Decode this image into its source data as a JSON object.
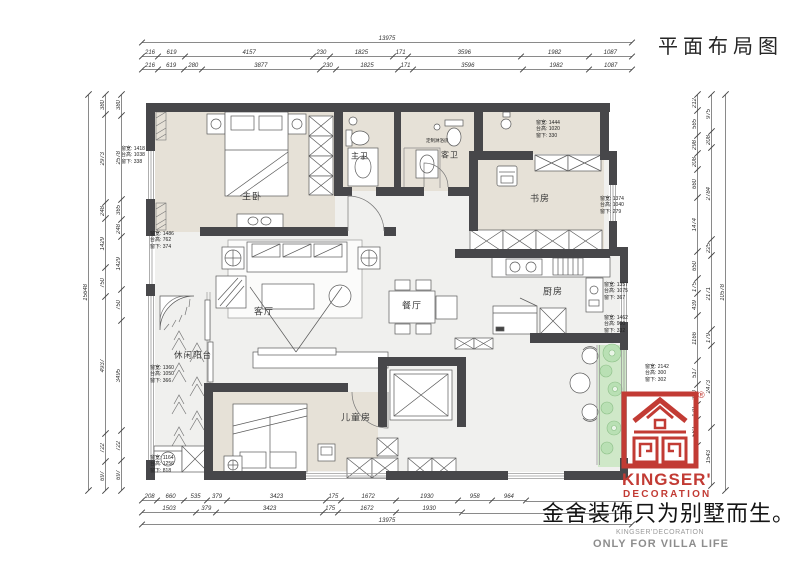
{
  "title": "平面布局图",
  "rooms": {
    "master": "主卧",
    "master_bath": "主卫",
    "guest_bath": "客卫",
    "study": "书房",
    "dining": "餐厅",
    "kitchen": "厨房",
    "living": "客厅",
    "leisure_balcony": "休闲阳台",
    "kids": "儿童房"
  },
  "shower_note": "定制淋浴房",
  "dims": {
    "top_overall": [
      "13975"
    ],
    "top_detail1": [
      "216",
      "619",
      "4157",
      "230",
      "1825",
      "171",
      "3596",
      "1982",
      "1087"
    ],
    "top_detail2": [
      "216",
      "619",
      "280",
      "3877",
      "230",
      "1825",
      "171",
      "3596",
      "1982",
      "1087"
    ],
    "bottom_detail1": [
      "208",
      "660",
      "535",
      "379",
      "3423",
      "175",
      "1672",
      "1930",
      "958",
      "964"
    ],
    "bottom_detail2": [
      "1503",
      "379",
      "3423",
      "175",
      "1672",
      "1930"
    ],
    "bottom_overall": [
      "13975"
    ],
    "left_overall": [
      "15648"
    ],
    "left_mid": [
      "380",
      "2973",
      "248",
      "1429",
      "750",
      "4937",
      "722",
      "697"
    ],
    "left_inner": [
      "380",
      "2578",
      "365",
      "248",
      "1429",
      "750",
      "3495",
      "722",
      "697"
    ],
    "right_inner": [
      "212",
      "565",
      "298",
      "208",
      "660",
      "1474",
      "650",
      "175",
      "439",
      "1166",
      "517",
      "350",
      "179",
      "562"
    ],
    "right_mid": [
      "975",
      "208",
      "2784",
      "225",
      "2171",
      "179",
      "2473",
      "1543"
    ],
    "right_overall": [
      "10578"
    ]
  },
  "annotations": [
    {
      "w": "窗宽: 1418",
      "t": "台高: 1038",
      "b": "窗下: 338"
    },
    {
      "w": "窗宽: 1486",
      "t": "台高: 762",
      "b": "窗下: 374"
    },
    {
      "w": "窗宽: 1360",
      "t": "台高: 1050",
      "b": "窗下: 366"
    },
    {
      "w": "窗宽: 1164",
      "t": "台高: 1256",
      "b": "窗下: 818"
    },
    {
      "w": "窗宽: 1444",
      "t": "台高: 1020",
      "b": "窗下: 330"
    },
    {
      "w": "窗宽: 1374",
      "t": "台高: 1040",
      "b": "窗下: 279"
    },
    {
      "w": "窗宽: 1357",
      "t": "台高: 1075",
      "b": "窗下: 367"
    },
    {
      "w": "窗宽: 1462",
      "t": "台高: 900",
      "b": "窗下: 332"
    },
    {
      "w": "窗宽: 2142",
      "t": "台高: 300",
      "b": "窗下: 302"
    }
  ],
  "brand": {
    "name_line1": "KINGSER'",
    "name_line2": "DECORATION",
    "registered": "®",
    "slogan": "金舍装饰只为别墅而生。",
    "sub_en1": "KINGSER'DECORATION",
    "sub_en2": "ONLY FOR VILLA LIFE"
  },
  "colors": {
    "wall": "#47474a",
    "room_fill": "#e6e1d7",
    "floor_fill": "#f0f0ee",
    "green": "#cfe8c8",
    "brand_red": "#c23b34"
  }
}
